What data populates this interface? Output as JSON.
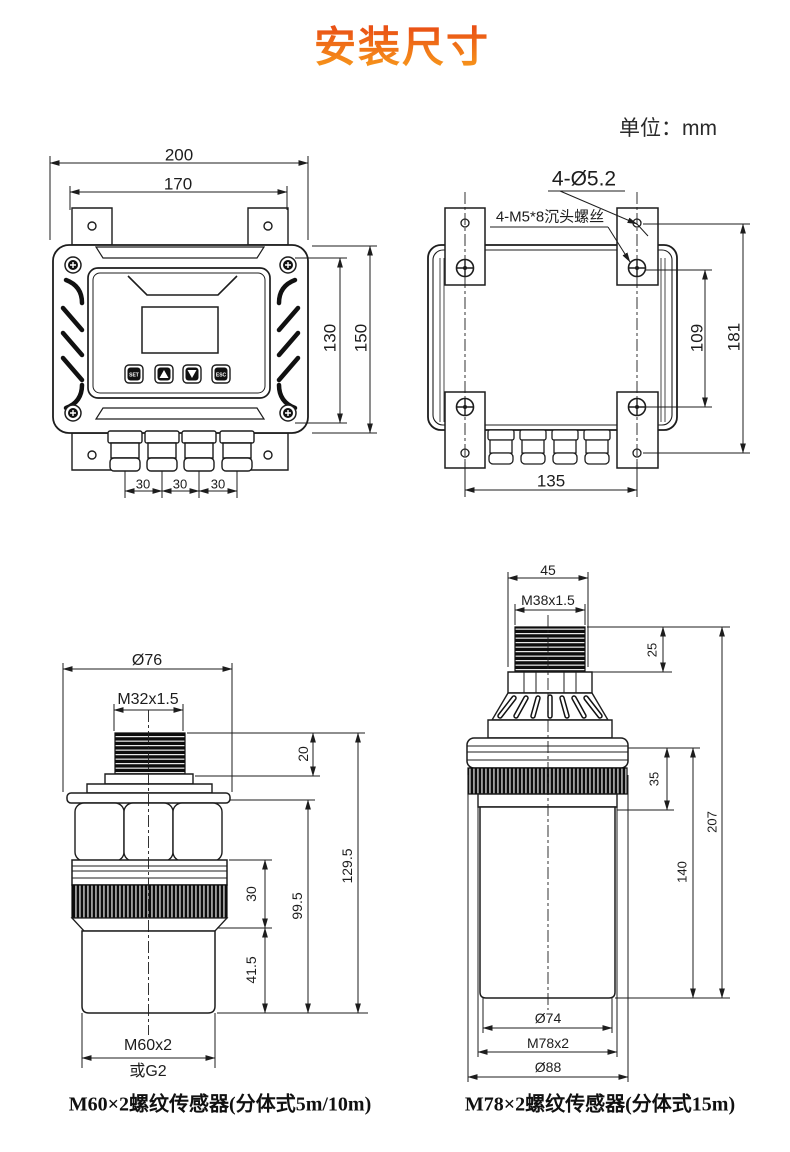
{
  "page": {
    "title": "安装尺寸",
    "unit_label": "单位：mm"
  },
  "controller_front": {
    "overall_width": "200",
    "mount_width": "170",
    "screw_spacing_height": "130",
    "overall_height": "150",
    "gland_spacings": [
      "30",
      "30",
      "30"
    ],
    "buttons": [
      "SET",
      "▲",
      "▼",
      "ESC"
    ]
  },
  "controller_back": {
    "hole_callout": "4-Ø5.2",
    "screw_callout": "4-M5*8沉头螺丝",
    "screw_spacing_v": "109",
    "hole_spacing_v": "181",
    "hole_spacing_h": "135"
  },
  "sensor_m60": {
    "flange_diameter": "Ø76",
    "top_thread": "M32x1.5",
    "thread_length": "20",
    "ring_length": "30",
    "tip_length": "41.5",
    "lower_length": "99.5",
    "total_length": "129.5",
    "bottom_thread": "M60x2",
    "alt_thread": "或G2",
    "caption": "M60×2螺纹传感器(分体式5m/10m)"
  },
  "sensor_m78": {
    "cap_width": "45",
    "top_thread": "M38x1.5",
    "thread_length": "25",
    "collar_length": "35",
    "body_length": "140",
    "total_length": "207",
    "tip_diameter": "Ø74",
    "bottom_thread": "M78x2",
    "flange_diameter": "Ø88",
    "caption": "M78×2螺纹传感器(分体式15m)"
  }
}
